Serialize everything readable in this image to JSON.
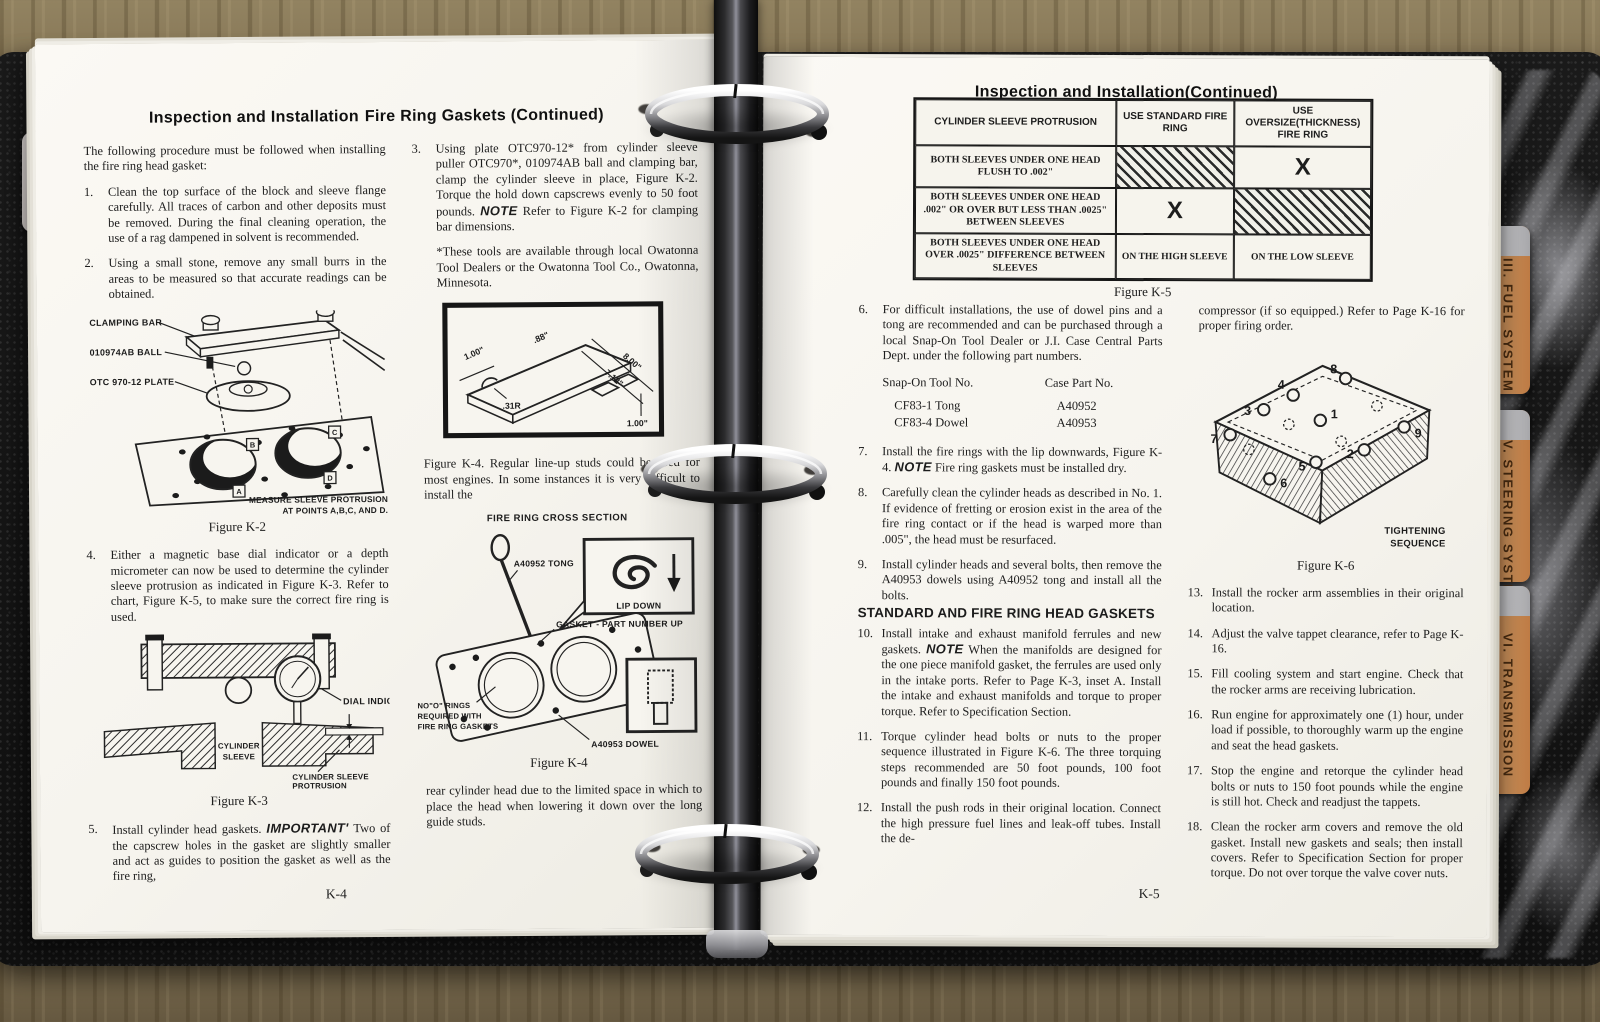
{
  "binder": {
    "tabs": [
      {
        "label": "III. FUEL SYSTEM"
      },
      {
        "label": "V. STEERING SYSTEM"
      },
      {
        "label": "VI. TRANSMISSION"
      }
    ]
  },
  "left_page": {
    "header_a": "Inspection and Installation",
    "header_b": "Fire Ring Gaskets (Continued)",
    "intro": "The following procedure must be followed when installing the fire ring head gasket:",
    "i1n": "1.",
    "i1": "Clean the top surface of the block and sleeve flange carefully. All traces of carbon and other deposits must be removed. During the final cleaning operation, the use of a rag dampened in solvent is recommended.",
    "i2n": "2.",
    "i2": "Using a small stone, remove any small burrs in the areas to be measured so that accurate readings can be obtained.",
    "i3n": "3.",
    "i3_pre": "Using plate OTC970-12* from cylinder sleeve puller OTC970*, 010974AB ball and clamping bar, clamp the cylinder sleeve in place, Figure K-2. Torque the hold down capscrews evenly to 50 foot pounds.",
    "i3_note": "NOTE",
    "i3_post": "Refer to Figure K-2 for clamping bar dimensions.",
    "footnote": "*These tools are available through local Owatonna Tool Dealers or the Owatonna Tool Co., Owatonna, Minnesota.",
    "i4n": "4.",
    "i4": "Either a magnetic base dial indicator or a depth micrometer can now be used to determine the cylinder sleeve protrusion as indicated in Figure K-3. Refer to chart, Figure K-5, to make sure the correct fire ring is used.",
    "i5n": "5.",
    "i5_pre": "Install cylinder head gaskets.",
    "i5_imp": "IMPORTANT'",
    "i5_post": "Two of the capscrew holes in the gasket are slightly smaller and act as guides to position the gasket as well as the fire ring,",
    "k4_intro": "Figure K-4. Regular line-up studs could be used for most engines. In some instances it is very difficult to install the",
    "outro": "rear cylinder head due to the limited space in which to place the head when lowering it down over the long guide studs.",
    "page_num": "K-4",
    "fig_k2": {
      "l1": "CLAMPING BAR",
      "l2": "010974AB BALL",
      "l3": "OTC 970-12 PLATE",
      "ma": "A",
      "mb": "B",
      "mc": "C",
      "md": "D",
      "note1": "MEASURE SLEEVE PROTRUSION",
      "note2": "AT POINTS A,B,C, AND D.",
      "caption": "Figure K-2"
    },
    "inset": {
      "d1": "1.00\"",
      "d2": ".88\"",
      "d3": "8.00\"",
      "d4": "7.12\"",
      "d5": ".31R",
      "d6": "1.00\""
    },
    "fig_k3": {
      "dial": "DIAL INDICATOR",
      "s1": "CYLINDER",
      "s2": "SLEEVE",
      "p1": "CYLINDER SLEEVE",
      "p2": "PROTRUSION",
      "caption": "Figure K-3"
    },
    "fig_k4": {
      "title": "FIRE RING CROSS SECTION",
      "tong": "A40952 TONG",
      "lip": "LIP DOWN",
      "gasket": "GASKET - PART NUMBER UP",
      "n1": "NO\"O\" RINGS",
      "n2": "REQUIRED WITH",
      "n3": "FIRE RING GASKETS",
      "dowel": "A40953 DOWEL",
      "caption": "Figure K-4"
    }
  },
  "right_page": {
    "header": "Inspection and Installation(Continued)",
    "k5": {
      "h1": "CYLINDER SLEEVE PROTRUSION",
      "h2": "USE STANDARD FIRE RING",
      "h3": "USE OVERSIZE(THICKNESS) FIRE RING",
      "r1c1": "BOTH SLEEVES UNDER ONE HEAD FLUSH TO .002\"",
      "r1x": "X",
      "r2c1": "BOTH SLEEVES UNDER ONE HEAD .002\" OR OVER BUT LESS THAN .0025\" BETWEEN SLEEVES",
      "r2x": "X",
      "r3c1": "BOTH SLEEVES UNDER ONE HEAD OVER .0025\" DIFFERENCE BETWEEN SLEEVES",
      "r3std": "ON THE HIGH SLEEVE",
      "r3ovs": "ON THE LOW SLEEVE",
      "caption": "Figure K-5"
    },
    "i6n": "6.",
    "i6": "For difficult installations, the use of dowel pins and a tong are recommended and can be purchased through a local Snap-On Tool Dealer or J.I. Case Central Parts Dept. under the following part numbers.",
    "parts": {
      "h1": "Snap-On Tool No.",
      "h2": "Case Part No.",
      "r1a": "CF83-1 Tong",
      "r1b": "A40952",
      "r2a": "CF83-4 Dowel",
      "r2b": "A40953"
    },
    "i7n": "7.",
    "i7_pre": "Install the fire rings with the lip downwards, Figure K-4.",
    "i7_note": "NOTE",
    "i7_post": "Fire ring gaskets must be installed dry.",
    "i8n": "8.",
    "i8": "Carefully clean the cylinder heads as described in No. 1. If evidence of fretting or erosion exist in the area of the fire ring contact or if the head is warped more than .005\", the head must be resurfaced.",
    "i9n": "9.",
    "i9": "Install cylinder heads and several bolts, then remove the A40953 dowels using A40952 tong and install all the bolts.",
    "subhead": "STANDARD AND FIRE RING HEAD GASKETS",
    "i10n": "10.",
    "i10_pre": "Install intake and exhaust manifold ferrules and new gaskets.",
    "i10_note": "NOTE",
    "i10_post": "When the manifolds are designed for the one piece manifold gasket, the ferrules are used only in the intake ports. Refer to Page K-3, inset A. Install the intake and exhaust manifolds and torque to proper torque. Refer to Specification Section.",
    "i11n": "11.",
    "i11": "Torque cylinder head bolts or nuts to the proper sequence illustrated in Figure K-6. The three torquing steps recommended are 50 foot pounds, 100 foot pounds and finally 150 foot pounds.",
    "i12n": "12.",
    "i12": "Install the push rods in their original location. Connect the high pressure fuel lines and leak-off tubes. Install the de-",
    "cont": "compressor (if so equipped.) Refer to Page K-16 for proper firing order.",
    "fig_k6": {
      "seq1": "TIGHTENING",
      "seq2": "SEQUENCE",
      "caption": "Figure K-6",
      "b1": "1",
      "b2": "2",
      "b3": "3",
      "b4": "4",
      "b5": "5",
      "b6": "6",
      "b7": "7",
      "b8": "8",
      "b9": "9"
    },
    "i13n": "13.",
    "i13": "Install the rocker arm assemblies in their original location.",
    "i14n": "14.",
    "i14": "Adjust the valve tappet clearance, refer to Page K-16.",
    "i15n": "15.",
    "i15": "Fill cooling system and start engine. Check that the rocker arms are receiving lubrication.",
    "i16n": "16.",
    "i16": "Run engine for approximately one (1) hour, under load if possible, to thoroughly warm up the engine and seat the head gaskets.",
    "i17n": "17.",
    "i17": "Stop the engine and retorque the cylinder head bolts or nuts to 150 foot pounds while the engine is still hot. Check and readjust the tappets.",
    "i18n": "18.",
    "i18": "Clean the rocker arm covers and remove the old gasket. Install new gaskets and seals; then install covers. Refer to Specification Section for proper torque. Do not over torque the valve cover nuts.",
    "page_num": "K-5"
  }
}
